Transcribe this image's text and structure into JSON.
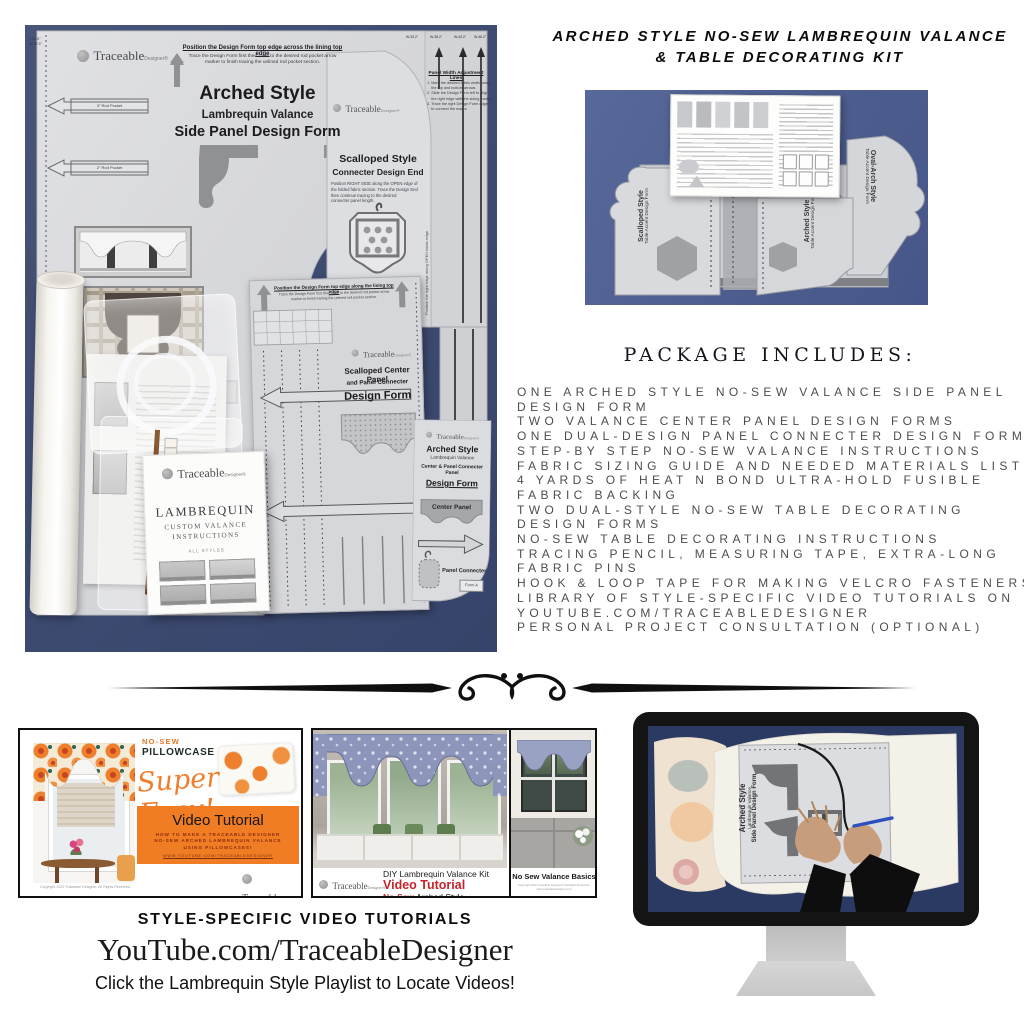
{
  "colors": {
    "photo_blue": "#3E4C72",
    "photo_blue_light": "#4C5D8D",
    "screen_navy": "#2B3A62",
    "accent_orange": "#F07C23",
    "accent_red": "#C4242B",
    "sheet_gray": "#D6D7DA",
    "text_gray": "#4D4D4D"
  },
  "title": {
    "line1": "ARCHED STYLE NO-SEW LAMBREQUIN VALANCE",
    "line2": "& TABLE DECORATING KIT"
  },
  "main_photo": {
    "corner_l": "L-26.5\"",
    "corner_w": "W-22.3\"",
    "brand": "Traceable",
    "brand_suffix": "Designer®",
    "header": "Position the Design Form top edge across the lining top edge",
    "header_sub": [
      "Trace the Design Form first then raise to the desired rod pocket arrow",
      "marker to finish tracing the unlined rod pocket section."
    ],
    "style": "Arched Style",
    "subtitle": "Lambrequin Valance",
    "form_name": "Side Panel Design Form",
    "rod_label_1": "3\" Rod Pocket",
    "rod_label_2": "2\" Rod Pocket",
    "edge_note": "the folded fabric edge to trace",
    "marker_label": "1\"",
    "scalloped_end": {
      "style": "Scalloped Style",
      "name": "Connecter Design End",
      "body": [
        "Position RIGHT SIDE along the OPEN edge of",
        "the folded fabric section. Trace the Design End",
        "then continue tracing to the desired",
        "connecter panel length."
      ],
      "edge_note": "Position the right edge along OPEN fabric edge"
    },
    "panel_width": {
      "title": "Panel Width Adjustment Lines",
      "steps": [
        "1. Mark the desired fabric width using",
        "    the top and bottom arrows.",
        "2. Slide the Design Form left to align",
        "    the right edge with the sizing marks.",
        "3. Trace the right Design Form edge",
        "    to connect the marks."
      ],
      "tick1": "W-33.2\"",
      "tick2": "W-38.2\"",
      "tick3": "W-43.2\"",
      "tick4": "W-48.2\""
    },
    "center_form": {
      "header": "Position the Design Form top edge along the lining top edge",
      "header_sub": [
        "Trace the Design Form first then raise to the desired rod pocket arrow",
        "marker to finish tracing the unlined rod pocket section."
      ],
      "brand": "Traceable",
      "brand_suffix": "Designer®",
      "title1": "Scalloped Center Panel",
      "title2": "and Panel Connecter",
      "title3": "Design Form"
    },
    "arched_card": {
      "brand": "Traceable",
      "brand_suffix": "Designer®",
      "style": "Arched Style",
      "subtitle": "Lambrequin Valance",
      "line": "Center & Panel Connecter Panel",
      "name": "Design Form",
      "center_panel": "Center Panel",
      "panel_connecter": "Panel Connecter",
      "form_no": "Form A"
    },
    "booklet": {
      "brand": "Traceable",
      "brand_suffix": "Designer®",
      "title": "LAMBREQUIN",
      "sub1": "CUSTOM VALANCE",
      "sub2": "INSTRUCTIONS",
      "note": "ALL STYLES"
    }
  },
  "table_photo": {
    "forms": [
      {
        "style": "Scalloped Style",
        "name": "Table Accent Design Form"
      },
      {
        "style": "Arched Style",
        "name": "Table Accent Design Form"
      },
      {
        "style": "Oval-Arch Style",
        "name": "Table Accent Design Form"
      }
    ]
  },
  "package": {
    "heading": "PACKAGE INCLUDES:",
    "lines": [
      "ONE ARCHED STYLE NO-SEW VALANCE SIDE PANEL",
      "DESIGN FORM",
      "TWO VALANCE CENTER PANEL DESIGN FORMS",
      "ONE DUAL-DESIGN PANEL CONNECTER DESIGN FORM",
      "STEP-BY STEP NO-SEW VALANCE INSTRUCTIONS",
      "FABRIC SIZING GUIDE AND NEEDED MATERIALS LIST",
      "4 YARDS OF HEAT N BOND ULTRA-HOLD FUSIBLE",
      "FABRIC BACKING",
      "TWO DUAL-STYLE NO-SEW TABLE DECORATING",
      "DESIGN FORMS",
      "NO-SEW TABLE DECORATING INSTRUCTIONS",
      "TRACING PENCIL, MEASURING TAPE, EXTRA-LONG",
      "FABRIC PINS",
      "HOOK & LOOP TAPE FOR MAKING VELCRO FASTENERS",
      "LIBRARY OF STYLE-SPECIFIC VIDEO TUTORIALS ON",
      "YOUTUBE.COM/TRACEABLEDESIGNER",
      "PERSONAL PROJECT CONSULTATION (OPTIONAL)"
    ]
  },
  "thumb1": {
    "tag": "NO-SEW",
    "product": "PILLOWCASE VALANCE",
    "script": "Super Easy!",
    "banner_title": "Video Tutorial",
    "banner_lines": [
      "HOW TO MAKE A TRACEABLE DESIGNER",
      "NO-SEW ARCHED LAMBREQUIN VALANCE",
      "USING PILLOWCASES!"
    ],
    "banner_link": "WWW.YOUTUBE.COM/TRACEABLEDESIGNER",
    "copyright": "Copyright 2022 Traceable Designer. All Rights Reserved.",
    "brand": "Traceable",
    "brand_suffix": "Designer®"
  },
  "thumb2": {
    "kit_title": "DIY Lambrequin Valance Kit",
    "video": "Video Tutorial",
    "style_red": "No-Sew",
    "style_black": " Arched Style",
    "brand": "Traceable",
    "brand_suffix": "Designer®",
    "caption": "No Sew Valance Basics",
    "caption_sub": "Copyright 2022 Traceable Designer® All Rights Reserved. www.traceabledesigner.com"
  },
  "monitor": {
    "form_style": "Arched Style",
    "form_subtitle": "Lambrequin Valance",
    "form_name": "Side Panel Design Form"
  },
  "footer": {
    "line1": "STYLE-SPECIFIC VIDEO TUTORIALS",
    "line2": "YouTube.com/TraceableDesigner",
    "line3": "Click the Lambrequin Style Playlist to Locate Videos!"
  }
}
